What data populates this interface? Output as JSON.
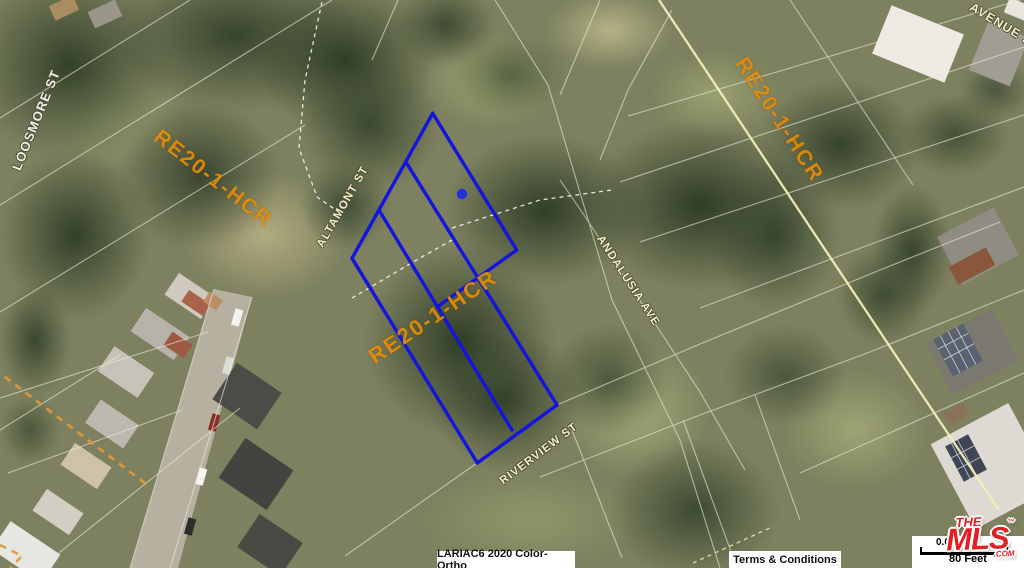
{
  "map": {
    "streets": [
      {
        "name": "LOOSMORE ST"
      },
      {
        "name": "ALTAMONT ST"
      },
      {
        "name": "ANDALUSIA AVE"
      },
      {
        "name": "RIVERVIEW ST"
      },
      {
        "name": "AVENUE 37"
      }
    ],
    "zoning_labels": [
      {
        "text": "RE20-1-HCR",
        "position": "upper-left"
      },
      {
        "text": "RE20-1-HCR",
        "position": "center"
      },
      {
        "text": "RE20-1-HCR",
        "position": "upper-right"
      }
    ],
    "marker": {
      "shape": "dot",
      "color": "#2330dd"
    },
    "subject_parcel_color": "#1315dc",
    "road_centerline_color": "#f4eeb4"
  },
  "footer": {
    "imagery_attribution": "LARIAC6 2020 Color-Ortho",
    "terms_link": "Terms & Conditions"
  },
  "scale": {
    "value": "0.0",
    "distance_label": "80 Feet"
  },
  "logo": {
    "line1": "THE",
    "line2": "MLS",
    "suffix": ".COM",
    "trademark": "™"
  },
  "colors": {
    "zoning_text": "#e68c06",
    "street_text": "#f3efc2",
    "parcel_line": "#ecebdc"
  }
}
